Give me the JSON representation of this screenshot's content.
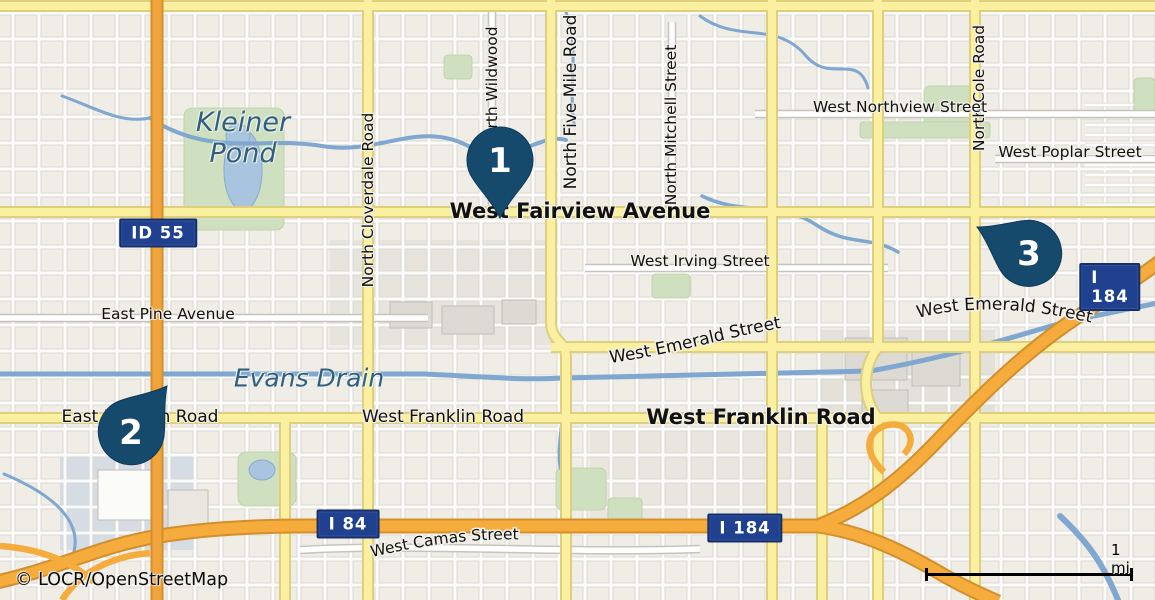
{
  "map": {
    "attribution": "© LOCR/OpenStreetMap",
    "scale": {
      "label": "1 mi"
    },
    "markers": [
      {
        "number": "1"
      },
      {
        "number": "2"
      },
      {
        "number": "3"
      }
    ],
    "shields": [
      {
        "label": "ID 55"
      },
      {
        "label": "I 84"
      },
      {
        "label": "I 184"
      },
      {
        "label": "I 184"
      }
    ],
    "water_labels": [
      {
        "text": "Kleiner Pond"
      },
      {
        "text": "Evans Drain"
      }
    ],
    "street_labels": [
      {
        "text": "North Cloverdale Road"
      },
      {
        "text": "North Wildwood"
      },
      {
        "text": "North Five Mile Road"
      },
      {
        "text": "North Mitchell Street"
      },
      {
        "text": "North Cole Road"
      },
      {
        "text": "West Northview Street"
      },
      {
        "text": "West Poplar Street"
      },
      {
        "text": "West Fairview Avenue"
      },
      {
        "text": "West Irving Street"
      },
      {
        "text": "East Pine Avenue"
      },
      {
        "text": "West Emerald Street"
      },
      {
        "text": "West Emerald Street"
      },
      {
        "text": "East Franklin Road"
      },
      {
        "text": "West Franklin Road"
      },
      {
        "text": "West Franklin Road"
      },
      {
        "text": "West Camas Street"
      }
    ],
    "colors": {
      "pin": "#164a6d",
      "shield_blue": "#20418f",
      "motorway_orange": "#f5ac3d",
      "major_road_yellow": "#faf0a0",
      "water_blue": "#7fa7cf",
      "land": "#efede6"
    }
  }
}
